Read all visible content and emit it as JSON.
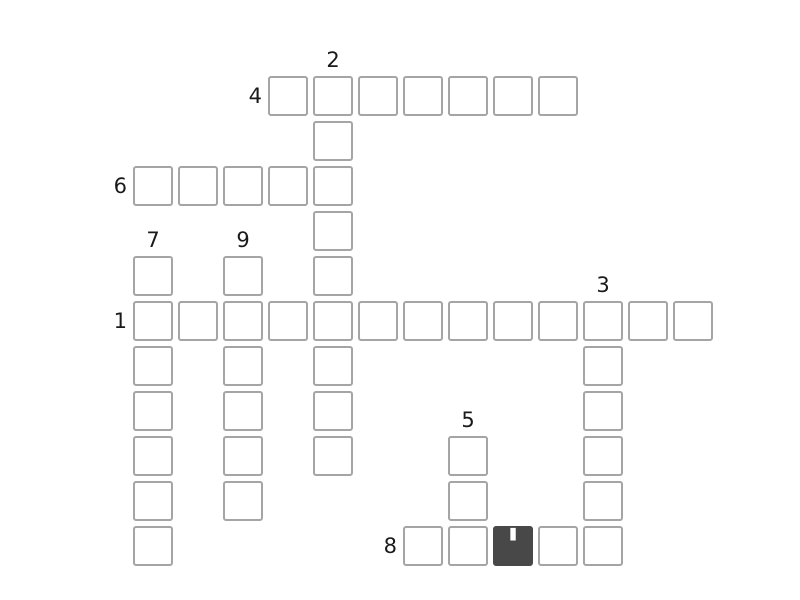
{
  "app": {
    "type": "crossword-puzzle"
  },
  "canvas": {
    "width": 800,
    "height": 600,
    "background": "#ffffff"
  },
  "grid": {
    "origin_x": 133,
    "origin_y": 76,
    "cell_size": 40,
    "cell_spacing": 45,
    "cell_border_color": "#a5a5a5",
    "cell_background": "#ffffff",
    "cell_corner_radius": 3,
    "label_color": "#1a1a1a",
    "label_font_size": 21,
    "prefilled_background": "#484848",
    "prefilled_text_color": "#ffffff"
  },
  "clues": [
    {
      "number": "1",
      "direction": "across",
      "col": 0,
      "row": 5,
      "length": 13
    },
    {
      "number": "2",
      "direction": "down",
      "col": 4,
      "row": 0,
      "length": 9
    },
    {
      "number": "3",
      "direction": "down",
      "col": 10,
      "row": 5,
      "length": 6
    },
    {
      "number": "4",
      "direction": "across",
      "col": 3,
      "row": 0,
      "length": 7
    },
    {
      "number": "5",
      "direction": "down",
      "col": 7,
      "row": 8,
      "length": 3
    },
    {
      "number": "6",
      "direction": "across",
      "col": 0,
      "row": 2,
      "length": 5
    },
    {
      "number": "7",
      "direction": "down",
      "col": 0,
      "row": 4,
      "length": 7
    },
    {
      "number": "8",
      "direction": "across",
      "col": 6,
      "row": 10,
      "length": 5
    },
    {
      "number": "9",
      "direction": "down",
      "col": 2,
      "row": 4,
      "length": 6
    }
  ],
  "prefilled_cells": [
    {
      "col": 8,
      "row": 10,
      "char": "'"
    }
  ]
}
